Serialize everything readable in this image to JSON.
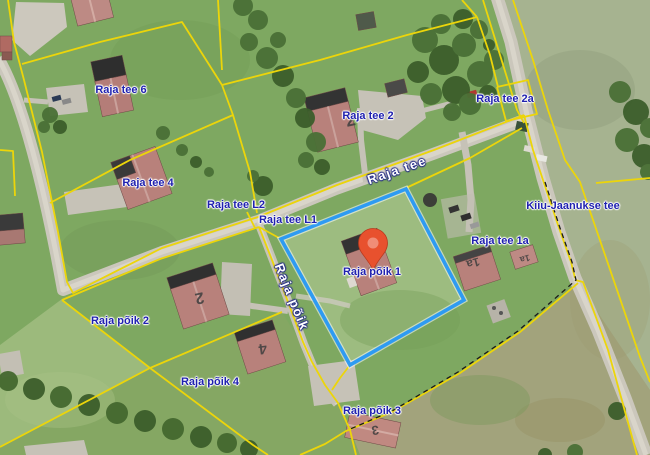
{
  "map": {
    "description": "Satellite-imagery cadastral map view with parcel boundaries",
    "parcel_labels": [
      {
        "text": "Raja tee 6"
      },
      {
        "text": "Raja tee 4"
      },
      {
        "text": "Raja tee L2"
      },
      {
        "text": "Raja tee L1"
      },
      {
        "text": "Raja tee 2"
      },
      {
        "text": "Raja tee 2a"
      },
      {
        "text": "Kiiu-Jaanukse tee"
      },
      {
        "text": "Raja tee 1a"
      },
      {
        "text": "Raja põik 1"
      },
      {
        "text": "Raja põik 2"
      },
      {
        "text": "Raja põik 4"
      },
      {
        "text": "Raja põik 3"
      }
    ],
    "road_labels": [
      {
        "text": "Raja tee"
      },
      {
        "text": "Raja põik"
      }
    ],
    "house_markings": [
      {
        "text": "2"
      },
      {
        "text": "2"
      },
      {
        "text": "4"
      },
      {
        "text": "1a"
      },
      {
        "text": "1a"
      },
      {
        "text": "3"
      }
    ],
    "selected_parcel": {
      "name": "Raja põik 1",
      "outline_color": "#2e9bf2"
    },
    "marker": {
      "type": "location-pin",
      "color": "#e8512e"
    },
    "colors": {
      "cadastral_line": "#ecd50a",
      "parcel_label": "#2021b0",
      "road_label_text": "#ffffff"
    }
  }
}
